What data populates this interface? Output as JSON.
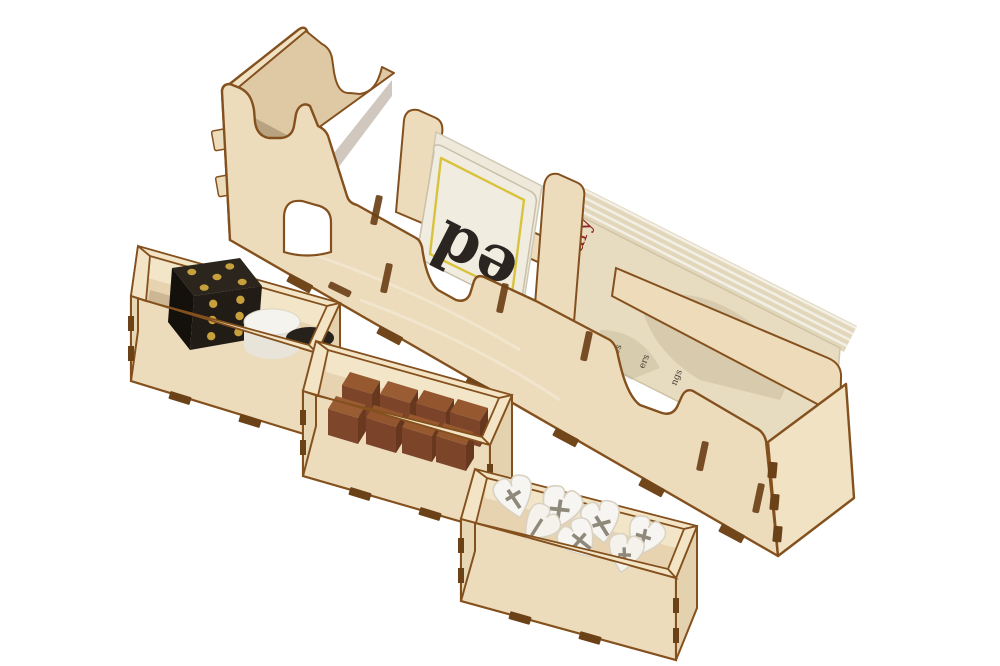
{
  "meta": {
    "description": "Product photo of a laser-cut birch plywood board game box insert: a long stepped card rack with three bays and three small open component trays, on a plain white background",
    "background_color": "#ffffff",
    "material": "laser-cut birch plywood with burnt brown edges"
  },
  "palette": {
    "wood": "#ecdcbc",
    "wood_light": "#f3e7cb",
    "wood_side": "#e4d2ae",
    "wood_interior": "#dfc9a5",
    "rim": "#f2e4c5",
    "burnt_edge": "#84511e",
    "burnt_dark": "#6b4117",
    "card_white": "#f0ece0",
    "card_cream": "#e8dcc0",
    "accent_yellow": "#d9c33e",
    "text_red": "#8d2626"
  },
  "card_rack": {
    "label": "stepped card holder rack",
    "bays": [
      {
        "label": "tall card bay",
        "contents": "empty",
        "features": [
          "curved access notch",
          "arched finger cutout"
        ]
      },
      {
        "label": "middle card bay",
        "contents": "letter cards",
        "card": {
          "visible_text": "ed",
          "text_color": "#2a2520",
          "border_color": "#d9c33e",
          "face_color": "#f0ece0"
        }
      },
      {
        "label": "long card bay",
        "contents": "leaning reference card stack",
        "card": {
          "visible_text": "mary",
          "text_color": "#8d2626",
          "face_color": "#e8dcc0",
          "edge_texts": [
            "P",
            "es",
            "ers",
            "ngs"
          ]
        }
      }
    ]
  },
  "trays": [
    {
      "label": "dice tray",
      "contents": {
        "die": {
          "color": "#211c16",
          "pip_color": "#c79f3c",
          "top_pips": 5,
          "front_pips": 6
        },
        "cylinder": {
          "color": "#f5f3ed"
        },
        "disc": {
          "color": "#26211b"
        }
      }
    },
    {
      "label": "cube tray",
      "contents": {
        "cubes": {
          "count": 8,
          "color": "#7c452a"
        }
      }
    },
    {
      "label": "token tray",
      "contents": {
        "tokens": {
          "count": 7,
          "color": "#f7f5f1",
          "mark": "grey cross mark",
          "mark_color": "#8f897b"
        }
      }
    }
  ]
}
